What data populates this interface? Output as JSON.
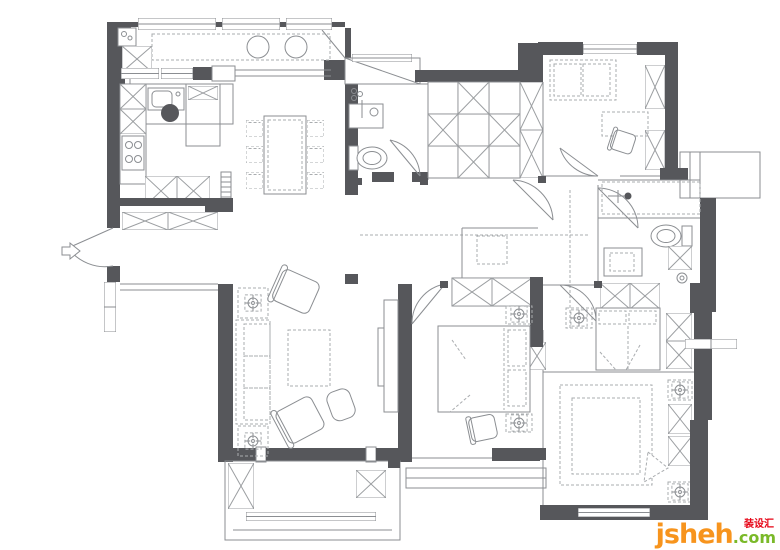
{
  "diagram": {
    "type": "apartment-floor-plan",
    "style": "architectural interior layout drawing, no room labels, no dimensions shown"
  },
  "palette": {
    "wall": "#56575b",
    "line": "#8b8e92",
    "furn": "#a9acaf",
    "hatch": "#9b9ea1",
    "paper": "#ffffff",
    "brand": "#f7941d",
    "tld": "#7ab929",
    "cjk": "#e60012"
  },
  "watermark": {
    "brand": "jsheh",
    "tld": ".com",
    "cjk": "装设汇"
  }
}
